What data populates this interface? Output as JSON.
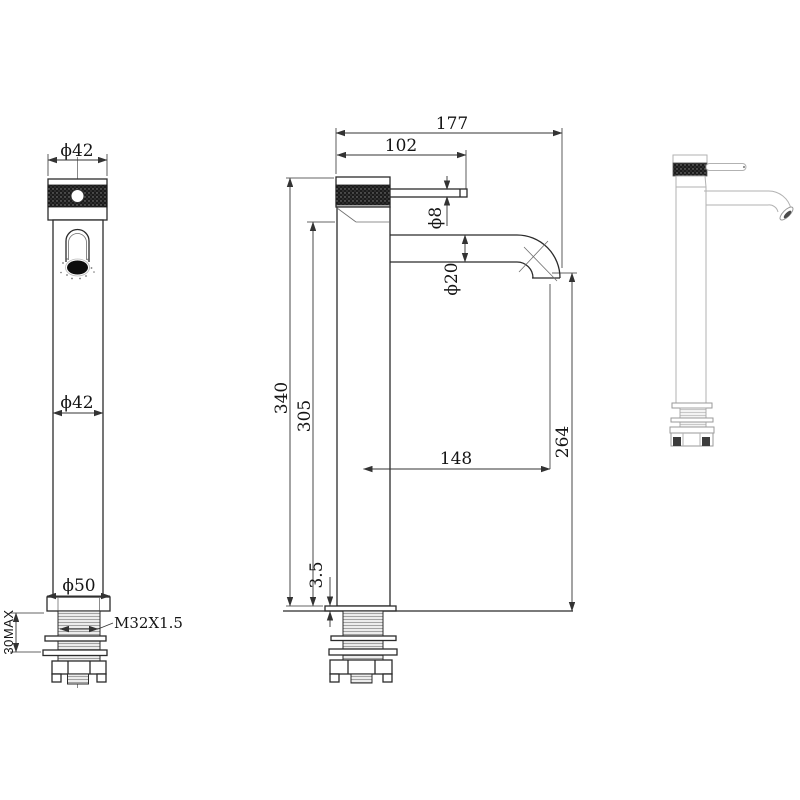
{
  "drawing": {
    "subject": "tall single-lever vessel basin mixer faucet technical drawing",
    "colors": {
      "background": "#ffffff",
      "outline": "#2b2b2b",
      "dimension": "#333333",
      "ghost_view": "#b2b2b2",
      "knurl_dark": "#1b1b1b"
    }
  },
  "front_view": {
    "top_diameter": "ϕ42",
    "body_diameter": "ϕ42",
    "base_diameter": "ϕ50",
    "max_mounting_thickness": "30MAX",
    "thread_spec": "M32X1.5"
  },
  "side_view": {
    "total_reach": "177",
    "lever_reach": "102",
    "lever_diameter": "ϕ8",
    "spout_diameter": "ϕ20",
    "total_height": "340",
    "body_height": "305",
    "spout_reach": "148",
    "spout_outlet_height": "264",
    "base_plate_thickness": "3.5"
  }
}
